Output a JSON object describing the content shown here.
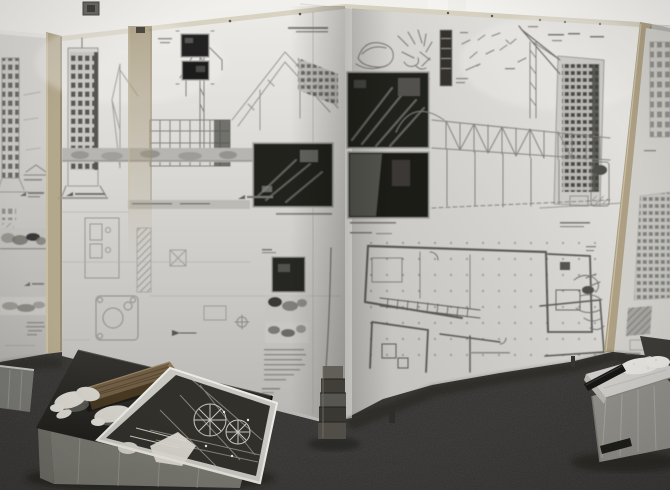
{
  "meta": {
    "type": "photograph",
    "subject": "Architecture exhibition room: zigzag white display panels covered with grayscale drawings, a low black presentation table with gloves, a wooden plank and an open portfolio, plastic storage bins on dark carpet",
    "lighting": "indoor, washed-out grayscale"
  },
  "palette": {
    "ceiling": "#f0efec",
    "wall_beam": "#f4f3f0",
    "carpet": "#454440",
    "paper": "#d6d5d1",
    "paper_bright": "#edebe7",
    "paper_shadow": "#b2b1ad",
    "frame_wood": "#b3a78c",
    "photo_dark": "#21201e",
    "pencil_ink": "#6f6e69",
    "plan_ink": "#4b4a46",
    "table_top": "#23221f",
    "plank_wood": "#6f5e45",
    "glove_white": "#d9d7cf",
    "bin_plastic": "#96958e",
    "bin_lid": "#cfceca",
    "latch_black": "#161614",
    "stand_gray": "#4a4945"
  },
  "scene": {
    "objects": [
      {
        "label": "white ceiling and wall"
      },
      {
        "label": "ceiling vent"
      },
      {
        "label": "thin cable along ceiling"
      },
      {
        "label": "far-left display panel with tower elevation, section headings and site sections"
      },
      {
        "label": "tan wooden frame post"
      },
      {
        "label": "left display panel with tower elevation, crane studies, photos, scaffold grid and detail plans"
      },
      {
        "label": "tan wooden mullion post"
      },
      {
        "label": "right display panel with concept sketches, site photos, tower elevation, truss bridge and large floor plan"
      },
      {
        "label": "right tan wooden frame post"
      },
      {
        "label": "far-right display panel with facade window grids"
      },
      {
        "label": "stacked gray stand at panel corner"
      },
      {
        "label": "dark gray carpet floor"
      },
      {
        "label": "panel support leg"
      },
      {
        "label": "plastic bin at left image edge"
      },
      {
        "label": "low black presentation table"
      },
      {
        "label": "translucent storage bin under table"
      },
      {
        "label": "wooden plank model piece"
      },
      {
        "label": "crumpled white cotton gloves"
      },
      {
        "label": "open portfolio of dark structural renderings"
      },
      {
        "label": "translucent storage bin with white lid"
      },
      {
        "label": "white bin lid with crumpled wrap"
      },
      {
        "label": "black bin latch"
      },
      {
        "label": "soft floor shadows"
      }
    ],
    "panels": {
      "far_left": {
        "drawings": [
          "tower elevation",
          "gable section sketch",
          "two headed sections with triangle bullets",
          "grayscale site section strips",
          "caption text block"
        ]
      },
      "left": {
        "drawings": [
          "tower elevation with flared base",
          "construction crane studies",
          "pair of small dark site photos",
          "diagonal axonometric roof study",
          "scaffold grid block",
          "gray terrain band",
          "large dark site photo with caption",
          "detail plans and hatched column",
          "rounded plan with circles",
          "column of photo, sketches and paragraph text"
        ]
      },
      "right": {
        "drawings": [
          "scribbled concept sketches with captions",
          "dark tower bar diagram",
          "scattered part sketches",
          "two large dark site photos",
          "tower elevation with crane boom",
          "truss bridge elevation on thin columns",
          "large multi-wing floor plan with column dots and stair run",
          "perspective scribble sketch"
        ]
      },
      "far_right": {
        "drawings": [
          "facade window grid",
          "dense facade grid",
          "dark hatched block"
        ]
      }
    },
    "table_items": [
      "wooden plank",
      "white gloves",
      "open portfolio print"
    ]
  }
}
